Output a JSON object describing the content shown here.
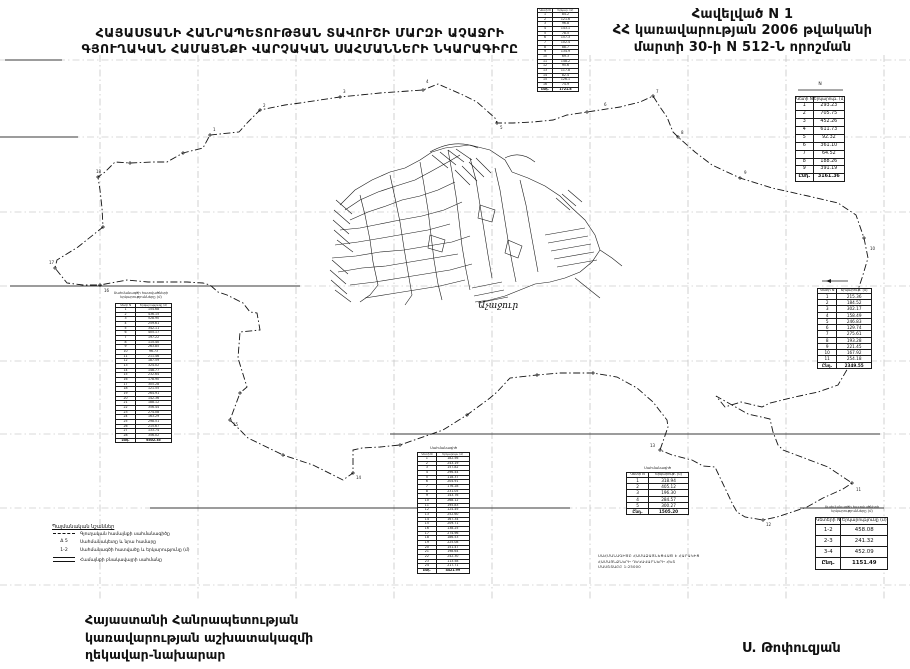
{
  "annex": {
    "line1": "Հավելված N 1",
    "line2": "ՀՀ կառավարության 2006 թվականի",
    "line3": "մարտի 30-ի N 512-Ն որոշման"
  },
  "title": {
    "line1": "ՀԱՅԱՍՏԱՆԻ ՀԱՆՐԱՊԵՏՈՒԹՅԱՆ ՏԱՎՈՒՇԻ ՄԱՐԶԻ ԱՉԱՋՐԻ",
    "line2": "ԳՅՈՒՂԱԿԱՆ ՀԱՄԱՅՆՔԻ ՎԱՐՉԱԿԱՆ ՍԱՀՄԱՆՆԵՐԻ ՆԿԱՐԱԳԻՐԸ"
  },
  "footer": {
    "left_lines": [
      "Հայաստանի Հանրապետության",
      "կառավարության աշխատակազմի",
      "ղեկավար-նախարար"
    ],
    "signature": "Ս. Թոփուզյան"
  },
  "map": {
    "settlement_label": "Աչաջուր",
    "point_labels": [
      {
        "t": "1",
        "x": 213,
        "y": 128
      },
      {
        "t": "2",
        "x": 263,
        "y": 104
      },
      {
        "t": "3",
        "x": 343,
        "y": 90
      },
      {
        "t": "4",
        "x": 426,
        "y": 80
      },
      {
        "t": "5",
        "x": 500,
        "y": 126
      },
      {
        "t": "6",
        "x": 604,
        "y": 103
      },
      {
        "t": "7",
        "x": 656,
        "y": 90
      },
      {
        "t": "8",
        "x": 681,
        "y": 131
      },
      {
        "t": "9",
        "x": 744,
        "y": 171
      },
      {
        "t": "10",
        "x": 870,
        "y": 247
      },
      {
        "t": "11",
        "x": 856,
        "y": 488
      },
      {
        "t": "12",
        "x": 766,
        "y": 523
      },
      {
        "t": "13",
        "x": 650,
        "y": 444
      },
      {
        "t": "14",
        "x": 356,
        "y": 476
      },
      {
        "t": "15",
        "x": 233,
        "y": 423
      },
      {
        "t": "16",
        "x": 104,
        "y": 289
      },
      {
        "t": "17",
        "x": 49,
        "y": 261
      },
      {
        "t": "18",
        "x": 96,
        "y": 170
      }
    ]
  },
  "legend": {
    "title": "Պայմանական նշաններ",
    "items": [
      {
        "symbol_text": "",
        "label": "Գյուղական համայնքի սահմանագիծը"
      },
      {
        "symbol_text": "Δ 5",
        "label": "Սահմանակետը և նրա համարը"
      },
      {
        "symbol_text": "1-2",
        "label": "Սահմանագծի հատվածը և երկարությունը (մ)"
      },
      {
        "symbol_text": "",
        "label": "Համայնքի բնակավայրի սահմանը"
      }
    ]
  },
  "note_lines": [
    "ՍԱՀՄԱՆԱԳԻԾԸ ՀԱՄԱՁԱՅՆԵՑՎԱԾ Է ՀԱՐԱԿԻՑ",
    "ՀԱՄԱՅՆՔՆԵՐԻ ՂԵԿԱՎԱՐՆԵՐԻ ՀԵՏ",
    "ՄԱՍՇՏԱԲԸ 1:25000"
  ],
  "tables": {
    "t1": {
      "caption_lines": [],
      "columns": [
        "Կետի N",
        "Երկար. (մ)"
      ],
      "rows": [
        [
          "1",
          "84.2"
        ],
        [
          "2",
          "121.6"
        ],
        [
          "3",
          "96.8"
        ],
        [
          "4",
          "143.1"
        ],
        [
          "5",
          "78.5"
        ],
        [
          "6",
          "157.3"
        ],
        [
          "7",
          "102.4"
        ],
        [
          "8",
          "88.7"
        ],
        [
          "9",
          "134.9"
        ],
        [
          "10",
          "69.3"
        ],
        [
          "11",
          "148.2"
        ],
        [
          "12",
          "95.6"
        ],
        [
          "13",
          "117.8"
        ],
        [
          "14",
          "82.4"
        ],
        [
          "15",
          "126.1"
        ],
        [
          "16",
          "74.9"
        ]
      ],
      "total": [
        "Ընդ.",
        "1721.8"
      ]
    },
    "t2": {
      "caption_lines": [
        "N"
      ],
      "columns": [
        "Կետի N",
        "Երկարութ. (մ)"
      ],
      "rows": [
        [
          "1",
          "293.23"
        ],
        [
          "2",
          "705.75"
        ],
        [
          "3",
          "452.26"
        ],
        [
          "4",
          "611.73"
        ],
        [
          "5",
          "92.32"
        ],
        [
          "6",
          "361.10"
        ],
        [
          "7",
          "64.52"
        ],
        [
          "8",
          "188.26"
        ],
        [
          "9",
          "391.19"
        ]
      ],
      "total": [
        "Ընդ.",
        "3161.36"
      ]
    },
    "t3": {
      "caption_lines": [],
      "columns": [
        "Կետի N",
        "Երկարութ. (մ)"
      ],
      "rows": [
        [
          "1",
          "215.36"
        ],
        [
          "2",
          "184.52"
        ],
        [
          "3",
          "302.17"
        ],
        [
          "4",
          "158.49"
        ],
        [
          "5",
          "246.83"
        ],
        [
          "6",
          "129.74"
        ],
        [
          "7",
          "275.61"
        ],
        [
          "8",
          "193.28"
        ],
        [
          "9",
          "221.45"
        ],
        [
          "10",
          "167.92"
        ],
        [
          "11",
          "254.18"
        ]
      ],
      "total": [
        "Ընդ.",
        "2349.55"
      ]
    },
    "t4": {
      "caption_lines": [
        "Սահմանագծի հատվածների",
        "երկարությունները (մ)"
      ],
      "columns": [
        "Կետի N",
        "Երկարությունը (մ)"
      ],
      "rows": [
        [
          "1",
          "154.68"
        ],
        [
          "2",
          "436.15"
        ],
        [
          "3",
          "528.90"
        ],
        [
          "4",
          "259.61"
        ],
        [
          "5",
          "342.11"
        ],
        [
          "6",
          "405.17"
        ],
        [
          "7",
          "197.22"
        ],
        [
          "8",
          "115.40"
        ],
        [
          "9",
          "263.85"
        ],
        [
          "10",
          "96.73"
        ],
        [
          "11",
          "211.46"
        ],
        [
          "12",
          "187.59"
        ],
        [
          "13",
          "324.02"
        ],
        [
          "14",
          "148.77"
        ],
        [
          "15",
          "232.64"
        ],
        [
          "16",
          "178.90"
        ],
        [
          "17",
          "305.28"
        ],
        [
          "18",
          "121.55"
        ],
        [
          "19",
          "264.91"
        ],
        [
          "20",
          "142.36"
        ],
        [
          "21",
          "188.12"
        ],
        [
          "22",
          "356.44"
        ],
        [
          "23",
          "274.08"
        ],
        [
          "24",
          "163.29"
        ],
        [
          "25",
          "298.51"
        ],
        [
          "26",
          "215.67"
        ],
        [
          "27",
          "133.74"
        ],
        [
          "28",
          "356.02"
        ]
      ],
      "total": [
        "Ընդ.",
        "6502.35"
      ]
    },
    "t5": {
      "caption_lines": [
        "Սահմանագիծ"
      ],
      "columns": [
        "Կետի N",
        "Երկարութ. (մ)"
      ],
      "rows": [
        [
          "1",
          "182.56"
        ],
        [
          "2",
          "243.19"
        ],
        [
          "3",
          "157.82"
        ],
        [
          "4",
          "296.44"
        ],
        [
          "5",
          "118.37"
        ],
        [
          "6",
          "204.91"
        ],
        [
          "7",
          "176.28"
        ],
        [
          "8",
          "231.05"
        ],
        [
          "9",
          "143.76"
        ],
        [
          "10",
          "268.12"
        ],
        [
          "11",
          "195.83"
        ],
        [
          "12",
          "124.49"
        ],
        [
          "13",
          "252.60"
        ],
        [
          "14",
          "167.34"
        ],
        [
          "15",
          "209.71"
        ],
        [
          "16",
          "138.25"
        ],
        [
          "17",
          "274.96"
        ],
        [
          "18",
          "186.53"
        ],
        [
          "19",
          "225.08"
        ],
        [
          "20",
          "151.47"
        ],
        [
          "21",
          "198.64"
        ],
        [
          "22",
          "242.30"
        ],
        [
          "23",
          "113.58"
        ],
        [
          "24",
          "217.71"
        ]
      ],
      "total": [
        "Ընդ.",
        "4421.99"
      ]
    },
    "t6": {
      "caption_lines": [
        "Սահմանագիծ"
      ],
      "columns": [
        "Կետի N",
        "Երկարութ. (մ)"
      ],
      "rows": [
        [
          "1",
          "318.94"
        ],
        [
          "2",
          "405.12"
        ],
        [
          "3",
          "196.30"
        ],
        [
          "4",
          "284.57"
        ],
        [
          "5",
          "300.27"
        ]
      ],
      "total": [
        "Ընդ.",
        "1505.20"
      ]
    },
    "t7": {
      "caption_lines": [
        "Սահմանագծի հատվածների",
        "երկարությունները (մ)"
      ],
      "columns": [
        "Կետերի N",
        "Երկարությունը (մ)"
      ],
      "rows": [
        [
          "1-2",
          "458.08"
        ],
        [
          "2-3",
          "241.32"
        ],
        [
          "3-4",
          "452.09"
        ]
      ],
      "total": [
        "Ընդ.",
        "1151.49"
      ]
    }
  }
}
